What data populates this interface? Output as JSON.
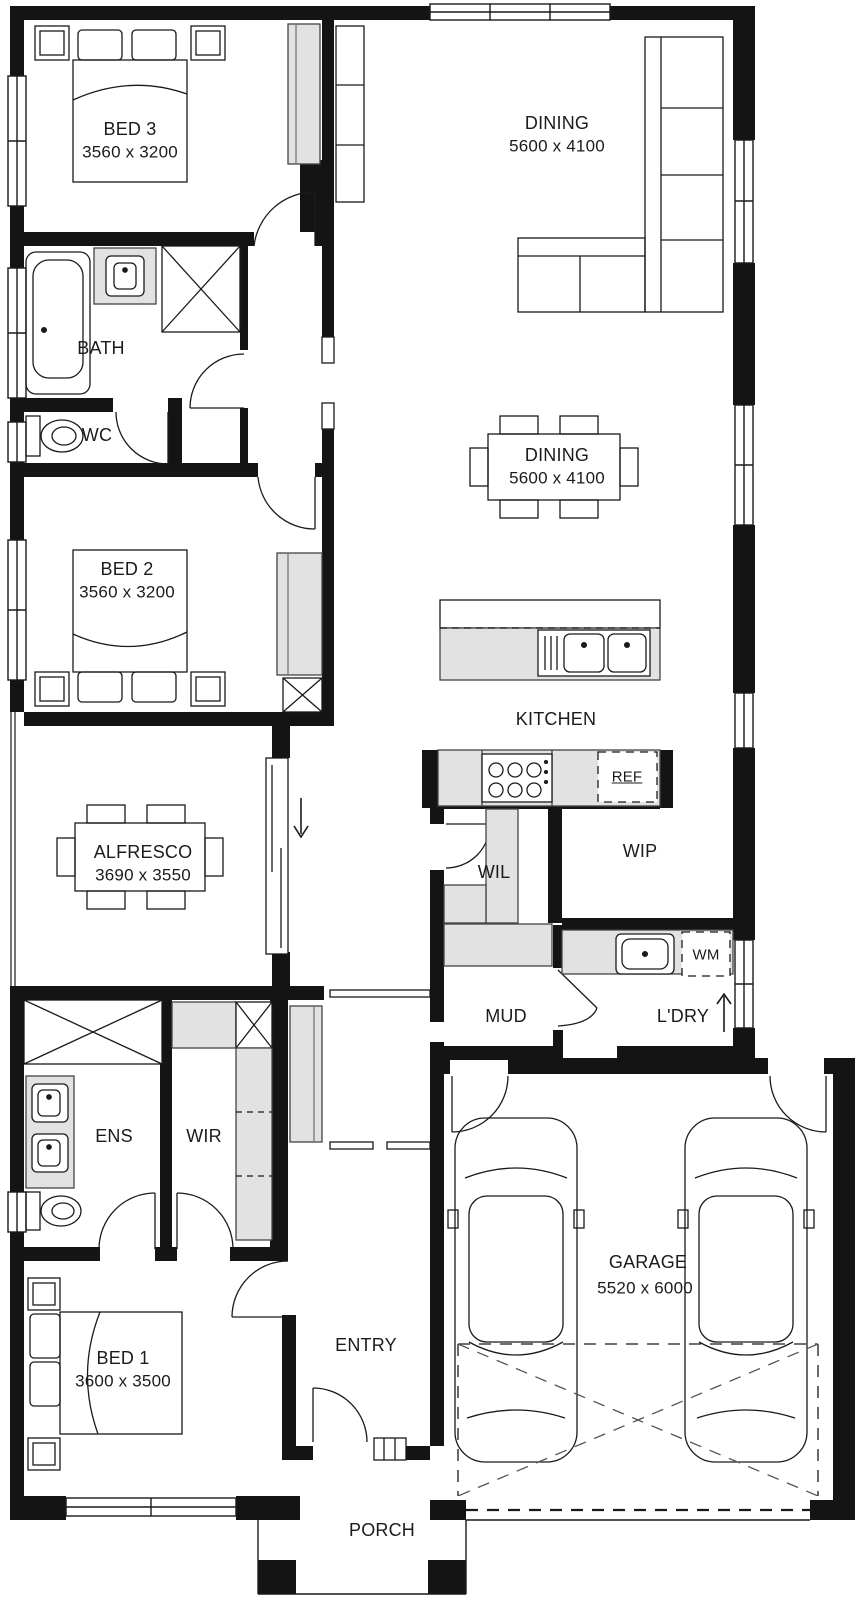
{
  "meta": {
    "type": "house-floor-plan"
  },
  "rooms": {
    "bed3": {
      "name": "BED 3",
      "dims": "3560 x 3200"
    },
    "living": {
      "name": "DINING",
      "dims": "5600 x 4100"
    },
    "bath": {
      "name": "BATH"
    },
    "wc": {
      "name": "WC"
    },
    "bed2": {
      "name": "BED 2",
      "dims": "3560 x 3200"
    },
    "dining": {
      "name": "DINING",
      "dims": "5600 x 4100"
    },
    "kitchen": {
      "name": "KITCHEN"
    },
    "alfresco": {
      "name": "ALFRESCO",
      "dims": "3690 x 3550"
    },
    "wil": {
      "name": "WIL"
    },
    "wip": {
      "name": "WIP"
    },
    "mud": {
      "name": "MUD"
    },
    "laundry": {
      "name": "L'DRY"
    },
    "ens": {
      "name": "ENS"
    },
    "wir": {
      "name": "WIR"
    },
    "bed1": {
      "name": "BED 1",
      "dims": "3600 x 3500"
    },
    "entry": {
      "name": "ENTRY"
    },
    "garage": {
      "name": "GARAGE",
      "dims": "5520 x 6000"
    },
    "porch": {
      "name": "PORCH"
    }
  },
  "appliances": {
    "fridge": "REF",
    "washing_machine": "WM"
  },
  "colors": {
    "wall": "#141414",
    "fixture_fill": "#e2e2e2",
    "line": "#1a1a1a",
    "background": "#ffffff"
  }
}
